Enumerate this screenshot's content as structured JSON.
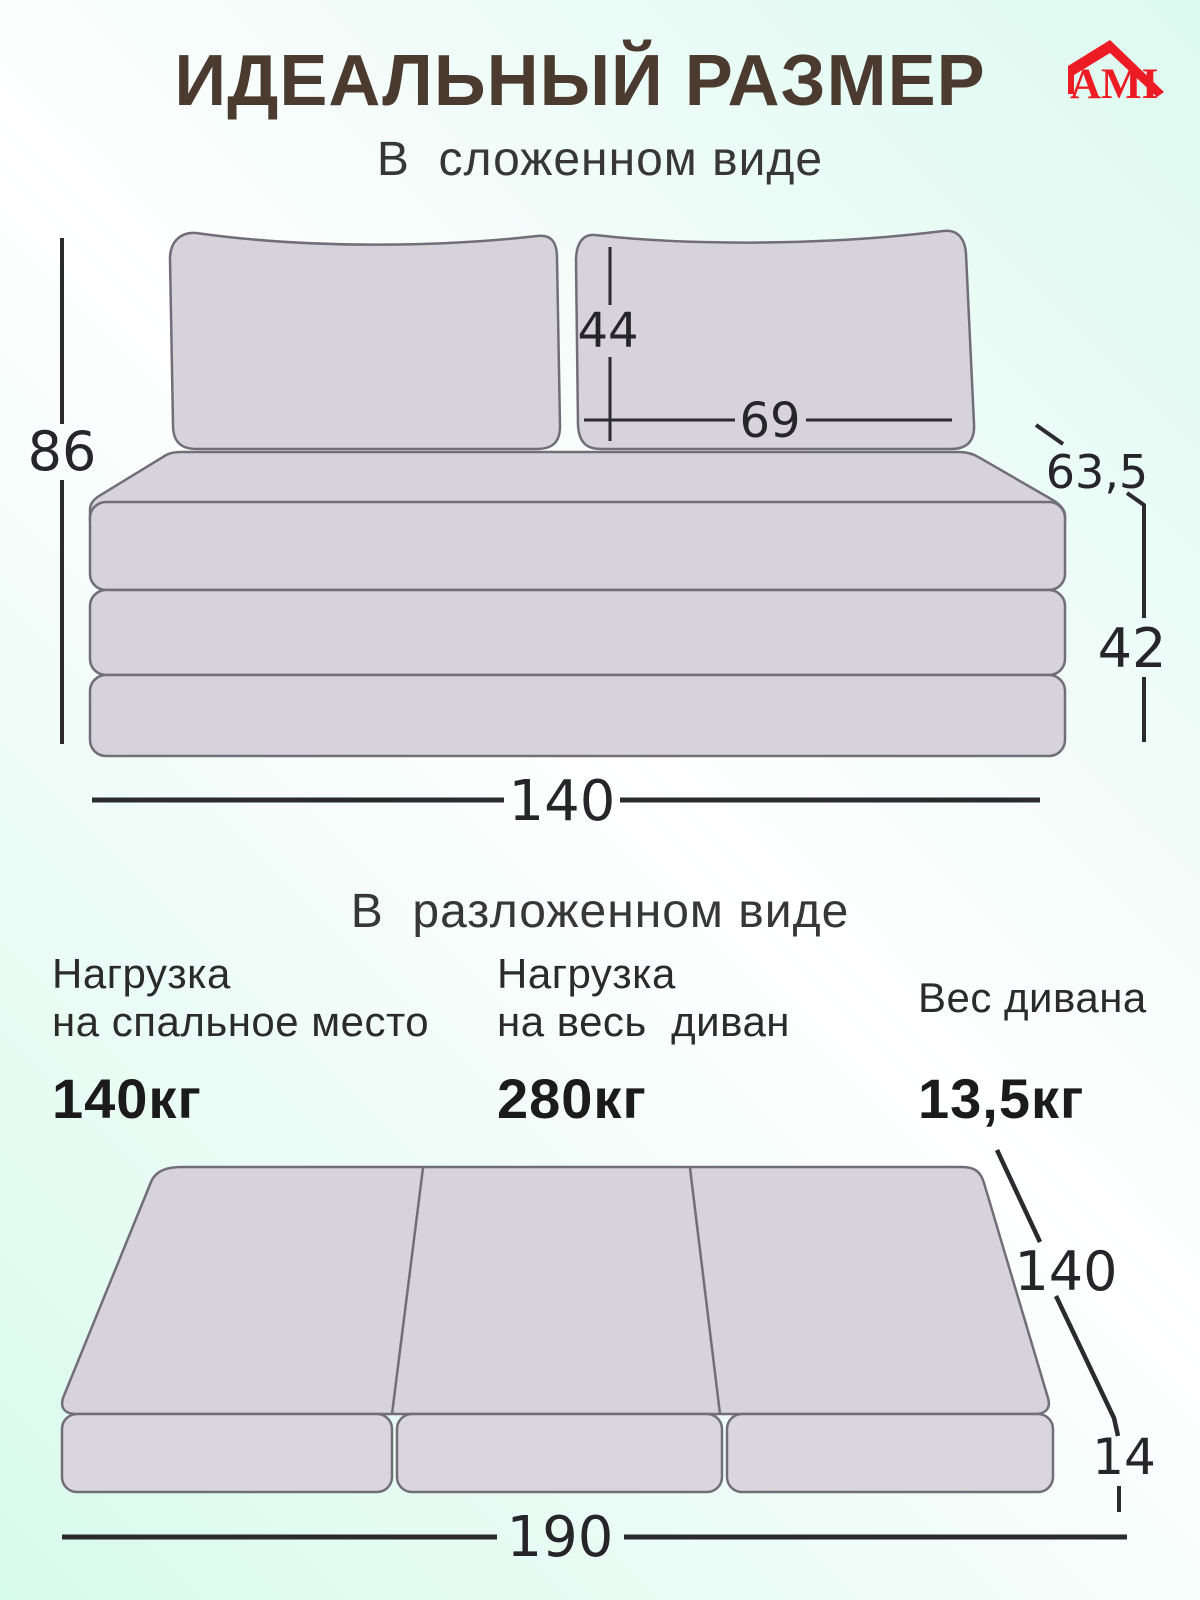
{
  "header": {
    "title": "ИДЕАЛЬНЫЙ РАЗМЕР",
    "title_color": "#4a3a30",
    "logo": {
      "text": "AMI",
      "color": "#ed1c24"
    }
  },
  "folded": {
    "heading": "В  сложенном виде",
    "dims": {
      "height": "86",
      "pillow_height": "44",
      "pillow_width": "69",
      "depth": "63,5",
      "base_height": "42",
      "width": "140"
    }
  },
  "unfolded": {
    "heading": "В  разложенном виде",
    "dims": {
      "depth": "140",
      "thickness": "14",
      "length": "190"
    }
  },
  "specs": [
    {
      "line1": "Нагрузка",
      "line2": "на спальное место",
      "value": "140кг"
    },
    {
      "line1": "Нагрузка",
      "line2": "на весь  диван",
      "value": "280кг"
    },
    {
      "line1": "Вес дивана",
      "line2": "",
      "value": "13,5кг"
    }
  ],
  "colors": {
    "background_mint": "#dcfaf0",
    "cushion_fill": "#d6d3dd",
    "outline": "#716e79",
    "dimension": "#26252a"
  }
}
